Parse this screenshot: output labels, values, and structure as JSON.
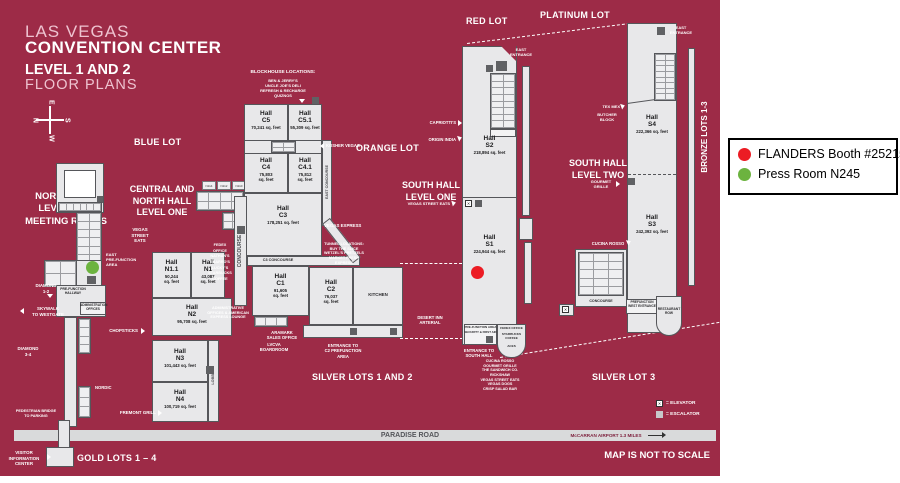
{
  "colors": {
    "map_bg": "#9d2b47",
    "booth_dot": "#ec1c24",
    "press_dot": "#6cb33f",
    "building": "#e8e8ea"
  },
  "legend": {
    "booth_label": "FLANDERS Booth #25215",
    "press_label": "Press Room N245"
  },
  "title": {
    "l1": "LAS VEGAS",
    "l2": "CONVENTION CENTER",
    "l3": "LEVEL 1 AND 2",
    "l4": "FLOOR PLANS"
  },
  "compass": {
    "n": "N",
    "e": "E",
    "s": "S",
    "w": "W"
  },
  "lots": {
    "blue": "BLUE LOT",
    "orange": "ORANGE LOT",
    "red": "RED LOT",
    "platinum": "PLATINUM LOT",
    "bronze": "BRONZE LOTS 1-3",
    "silver12": "SILVER LOTS 1 AND 2",
    "silver3": "SILVER LOT 3",
    "gold": "GOLD LOTS 1 – 4"
  },
  "area_titles": {
    "north": "NORTH HALL\nLEVEL TWO\nMEETING ROOMS",
    "central": "CENTRAL AND\nNORTH HALL\nLEVEL ONE",
    "south1": "SOUTH HALL\nLEVEL ONE",
    "south2": "SOUTH HALL\nLEVEL TWO"
  },
  "halls": {
    "c5": {
      "name": "Hall\nC5",
      "sqft": "70,241 sq. feet"
    },
    "c5_1": {
      "name": "Hall\nC5.1",
      "sqft": "55,309 sq. feet"
    },
    "c4": {
      "name": "Hall\nC4",
      "sqft": "75,803\nsq. feet"
    },
    "c4_1": {
      "name": "Hall\nC4.1",
      "sqft": "75,812\nsq. feet"
    },
    "c3": {
      "name": "Hall\nC3",
      "sqft": "178,251 sq. feet"
    },
    "c1": {
      "name": "Hall\nC1",
      "sqft": "91,605\nsq. feet"
    },
    "c2": {
      "name": "Hall\nC2",
      "sqft": "76,037\nsq. feet"
    },
    "n1_1": {
      "name": "Hall\nN1.1",
      "sqft": "50,244\nsq. feet"
    },
    "n1": {
      "name": "Hall\nN1",
      "sqft": "43,087\nsq. feet"
    },
    "n2": {
      "name": "Hall\nN2",
      "sqft": "95,708 sq. feet"
    },
    "n3": {
      "name": "Hall\nN3",
      "sqft": "101,443 sq. feet"
    },
    "n4": {
      "name": "Hall\nN4",
      "sqft": "100,719 sq. feet"
    },
    "s1": {
      "name": "Hall\nS1",
      "sqft": "224,944 sq. feet"
    },
    "s2": {
      "name": "Hall\nS2",
      "sqft": "218,894 sq. feet"
    },
    "s3": {
      "name": "Hall\nS3",
      "sqft": "242,392 sq. feet"
    },
    "s4": {
      "name": "Hall\nS4",
      "sqft": "222,366 sq. feet"
    }
  },
  "rooms": {
    "row": [
      "N114",
      "N112",
      "N110"
    ]
  },
  "labels": {
    "blockhouse_title": "BLOCKHOUSE LOCATIONS:",
    "blockhouse_items": "BEN & JERRY'S\nUNCLE JOE'S DELI\nREFRESH & RECHARGE\nQUIZNOS",
    "kosher": "KOSHER VEGAS",
    "capriottis": "CAPRIOTTI'S",
    "origin": "ORIGIN INDIA",
    "vegas_express": "VEGAS EXPRESS",
    "tunnel": "TUNNEL LOCATIONS:\nBUY THE SLICE\nWETZEL'S PRETZELS\nMARKET FRESH EXPRESS",
    "street_eats_stack": "VEGAS\nSTREET\nEATS",
    "street_eats": "VEGAS STREET EATS",
    "food_column": "FEDEX OFFICE\nNATHAN'S\nSBARRO'S\nLUCKY'S\nSTARBUCKS\nCOFFEE",
    "admin_lounge": "ADMINISTRATIVE\nOFFICES & AMERICAN\nEXPRESS LOUNGE",
    "aramark": "ARAMARK\nSALES OFFICE",
    "lvcva": "LVCVA\nBOARDROOM",
    "chopsticks": "CHOPSTICKS",
    "fremont": "FREMONT GRILL",
    "nordic": "NORDIC",
    "texmex": "TEX MEX",
    "butcher": "BUTCHER\nBLOCK",
    "gourmet": "GOURMET\nGRILLE",
    "cucina": "CUCINA ROSSO",
    "diamond12": "DIAMOND\n1-2",
    "diamond34": "DIAMOND\n3-4",
    "skywalk": "SKYWALK\nTO WESTGATE",
    "ped_bridge": "PEDESTRIAN BRIDGE\nTO PARKING",
    "visitor": "VISITOR\nINFORMATION\nCENTER",
    "east_prefunction": "EAST\nPRE-FUNCTION\nAREA",
    "east_entrance": "EAST\nENTRANCE",
    "desert_inn": "DESERT INN\nARTERIAL",
    "c2_entrance": "ENTRANCE TO\nC2 PREFUNCTION\nAREA",
    "south_entrance": "ENTRANCE TO\nSOUTH HALL",
    "south_food": "CUCINA ROSSO\nGOURMET GRILLE\nTHE SANDWICH CO.\nRICKSHAW\nVEGAS STREET EATS\nVEGAS DOGS\nCRISP SALAD BAR",
    "prefunction_area": "PRE-FUNCTION AREA",
    "security": "SECURITY & FIRST AID",
    "fedex": "FEDEX OFFICE",
    "starbucks": "STARBUCKS\nCOFFEE",
    "aces": "ACES",
    "concourse": "CONCOURSE",
    "east_concourse": "EAST CONCOURSE",
    "c3_concourse": "C3 CONCOURSE",
    "lobby": "LOBBY",
    "prefunction_hallway": "PRE-FUNCTION\nHALLWAY",
    "admin_offices": "ADMINISTRATION\nOFFICES",
    "kitchen": "KITCHEN",
    "restaurant_row": "RESTAURANT\nROW",
    "west_entrance": "PREFUNCTION\nWEST ENTRANCE"
  },
  "road": {
    "paradise": "PARADISE ROAD",
    "airport": "McCARRAN AIRPORT 1.3 MILES",
    "notscale": "MAP IS NOT TO SCALE"
  },
  "map_legend": {
    "elevator": "= ELEVATOR",
    "escalator": "= ESCALATOR",
    "x": "✕"
  }
}
